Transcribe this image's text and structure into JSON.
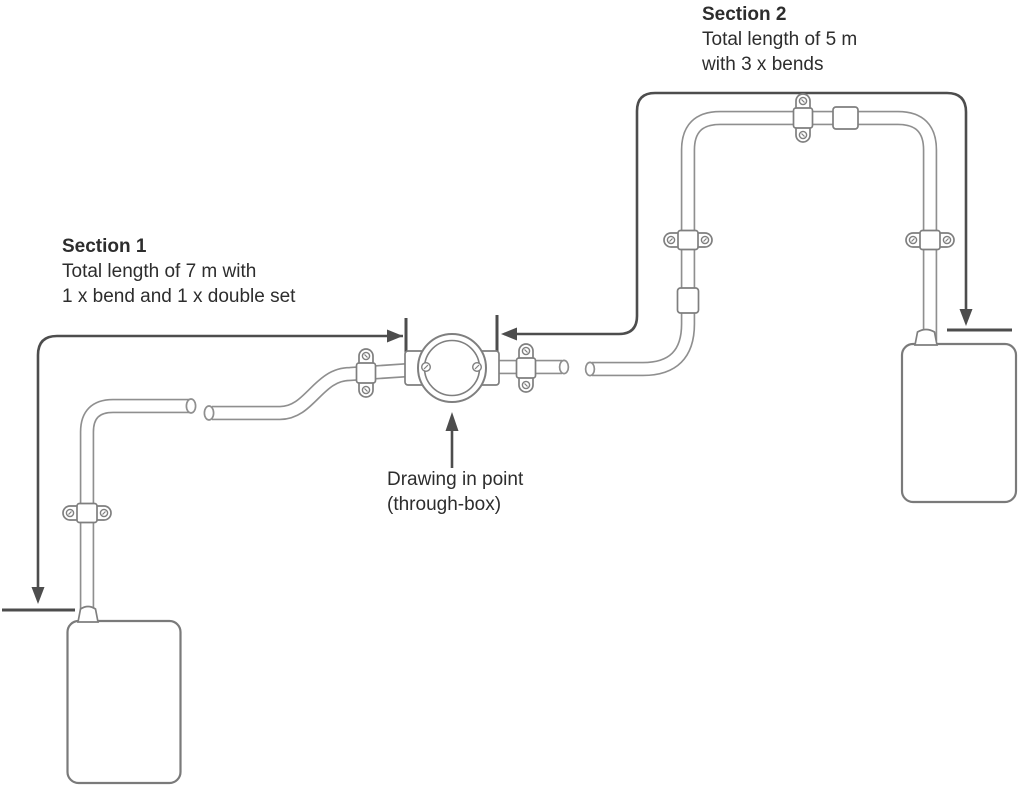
{
  "labels": {
    "section1": {
      "title": "Section 1",
      "line1": "Total length of 7 m with",
      "line2": "1 x bend and 1 x double set"
    },
    "section2": {
      "title": "Section 2",
      "line1": "Total length of 5 m",
      "line2": "with 3 x bends"
    },
    "drawing_in_point": {
      "line1": "Drawing in point",
      "line2": "(through-box)"
    }
  },
  "colors": {
    "pipe_outline": "#8f8f8f",
    "fixture_outline": "#7f7f7f",
    "box_outline": "#7a7a7a",
    "dimension_line": "#4d4d4d",
    "text": "#2d2d2d",
    "background": "#ffffff"
  }
}
